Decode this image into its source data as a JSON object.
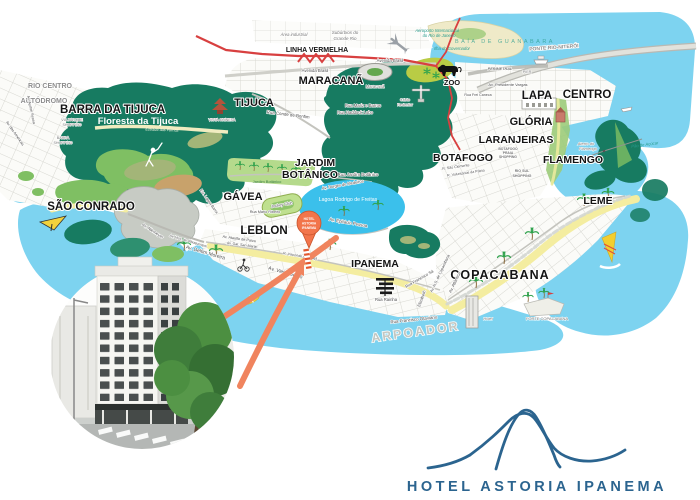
{
  "branding": {
    "logo_text": "HOTEL ASTORIA IPANEMA",
    "logo_color": "#2b648f",
    "logo_icon": "sugarloaf-mountain-line-drawing"
  },
  "map": {
    "marker": {
      "line1": "HOTEL",
      "line2": "ASTORIA",
      "line3": "IPANEMA"
    },
    "districts": {
      "rio_centro": "RIO CENTRO",
      "autodromo": "AUTÓDROMO",
      "barra_da_tijuca": "BARRA DA TIJUCA",
      "floresta_da_tijuca": "Floresta da Tijuca",
      "tijuca": "TIJUCA",
      "maracana": "MARACANÃ",
      "sao_conrado": "SÃO CONRADO",
      "gavea": "GÁVEA",
      "jardim": "JARDIM",
      "botanico": "BOTÂNICO",
      "leblon": "LEBLON",
      "ipanema": "IPANEMA",
      "copacabana": "COPACABANA",
      "arpoador": "ARPOADOR",
      "leme": "LEME",
      "botafogo": "BOTAFOGO",
      "flamengo": "FLAMENGO",
      "laranjeiras": "LARANJEIRAS",
      "gloria": "GLÓRIA",
      "lapa": "LAPA",
      "centro": "CENTRO",
      "zoo": "ZOO"
    },
    "roads": {
      "linha_vermelha": "LINHA VERMELHA",
      "ponte_rio_niteroi": "PONTE RIO-NITERÓI",
      "perimetral": "PERIMETRAL",
      "pier": "PIER",
      "av_presidente_vargas": "Av. Presidente Vargas",
      "rua_frei_caneca": "Rua Frei Caneca",
      "avenida_brasil": "Avenida Brasil",
      "rua_conde_de_bonfim": "Rua Conde de Bonfim",
      "rua_haddock_lobo": "Rua Haddock Lobo",
      "rua_mariz_e_barros": "Rua Mariz e Barros",
      "rua_jardim_botanico": "Rua Jardim Botânico",
      "av_borges_de_medeiros": "Av. Borges de Medeiros",
      "av_epitacio_pessoa": "Av. Epitácio Pessoa",
      "rua_mario_ribeiro": "Rua Mário Ribeiro",
      "est_lagoa_barra": "Est. Lagoa-Barra",
      "av_niemeyer": "Av. Niemeyer",
      "av_visc_albuquerque": "Av. Visc. de Albuquerque",
      "av_delfim_moreira": "Av. Delfim Moreira",
      "av_vieira_souto": "Av. Vieira Souto",
      "av_ataulfo_de_paiva": "Av. Ataulfo de Paiva",
      "av_gal_san_martin": "Av. Gal. San Martin",
      "r_visconde_de_piraja": "R. Visconde de Pirajá",
      "rua_francisco_sa": "Rua Francisco Sá",
      "rua_rainha": "Rua Rainha",
      "elizabeth": "Elizabeth",
      "rua_francisco_otaviano": "Rua Francisco Otaviano",
      "av_atlantica": "Av. Atlântica",
      "av_ns_copacabana": "Av. N.S. de Copacabana",
      "estrada_das_furnas": "Estrada das Furnas",
      "rua_sao_clemente": "R. São Clemente",
      "rua_voluntarios": "R. Voluntários da Pátria",
      "av_ayrton_senna": "Av. Ayrton Senna",
      "av_das_americas": "Av. das Américas"
    },
    "places": {
      "area_industrial": "Área industrial",
      "suburbios_1": "Subúrbios do",
      "suburbios_2": "Grande Rio",
      "aeroporto_1": "Aeroporto Internacional",
      "aeroporto_2": "do Rio de Janeiro",
      "ilha_governador": "Ilha do Governador",
      "baia_guanabara": "BAÍA DE GUANABARA",
      "cristo_1": "Cristo",
      "cristo_2": "Redentor",
      "maracana_stadium": "Maracanã",
      "vista_chinesa": "VISTA CHINESA",
      "via_parque_1": "VIA PARQUE",
      "via_parque_2": "SHOPPING",
      "barra_shopping_1": "BARRA",
      "barra_shopping_2": "SHOPPING",
      "jardim_botanico_garden": "Jardim Botânico",
      "jockey_club": "Jockey Club",
      "lagoa": "Lagoa Rodrigo de Freitas",
      "botafogo_praia_1": "BOTAFOGO",
      "botafogo_praia_2": "PRAIA",
      "botafogo_praia_3": "SHOPPING",
      "rio_sul_1": "RIO SUL",
      "rio_sul_2": "SHOPPING",
      "aterro_1": "Aterro do",
      "aterro_2": "Flamengo",
      "pao_de_acucar": "Pão de Açúcar",
      "forte_copacabana": "FORTE COPACABANA",
      "hotel_small": "Hotel"
    },
    "colors": {
      "water": "#7dd3f0",
      "lagoon": "#3bc0eb",
      "forest": "#177b61",
      "hills": "#7fbf63",
      "sand": "#f4eda0",
      "marker_orange": "#f2754b",
      "arrow_salmon": "#f0845e",
      "road_red": "#d84040",
      "logo_blue": "#2b648f"
    },
    "icons": {
      "hang-glider-icon": "yellow hang glider",
      "golfer-icon": "white golfer silhouette",
      "surfer-icon": "surfer with yellow surfboard",
      "cyclist-icon": "cyclist on beach avenue",
      "windsurfer-icon": "yellow windsurf sail",
      "zoo-lion-icon": "black lion",
      "airplane-icon": "gray airplane",
      "cristo-icon": "Christ the Redeemer statue",
      "stadium-icon": "Maracanã stadium",
      "palm-icon": "palm tree",
      "ship-icon": "white ship",
      "pagoda-icon": "Vista Chinesa pagoda",
      "location-pin-icon": "orange balloon marker",
      "aqueduct-icon": "Lapa arches",
      "church-icon": "Glória church"
    }
  }
}
